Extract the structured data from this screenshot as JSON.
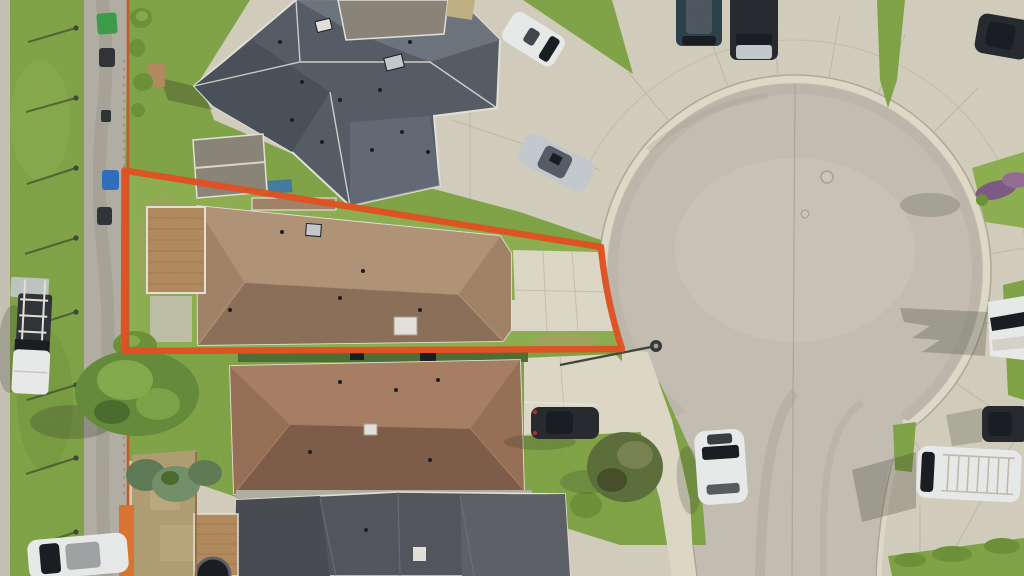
{
  "scene": {
    "type": "aerial-drone-photo",
    "subject": "residential cul-de-sac street with one property lot outlined by an orange boundary overlay"
  },
  "colors": {
    "boundary": "#E8501E",
    "concrete": "#d8d2c1",
    "concrete_light": "#e4ddcb",
    "concrete_dark": "#c6bfad",
    "bulb": "#c9c3b6",
    "bulb_light": "#d2ccbf",
    "lane": "#b6b2a7",
    "lane_stain": "#a09c90",
    "walk_left": "#cac6b9",
    "grass": "#82a746",
    "grass_bright": "#8fb350",
    "grass_dark": "#6d9436",
    "grass_dry": "#a9a565",
    "dirt": "#b3a174",
    "dirt_light": "#c4b584",
    "hedge": "#4e6e33",
    "tree": "#648e39",
    "tree_light": "#85ae4c",
    "tree_dark": "#4a6d2c",
    "spruce": "#5e7d55",
    "spruce_light": "#74926b",
    "conifer": "#5d6f3b",
    "conifer_light": "#7a8450",
    "conifer_dark": "#454e28",
    "shrub_purple": "#7e5a85",
    "shrub_purple_light": "#966f97",
    "roof_top": "#565c66",
    "roof_top_light": "#6f7681",
    "roof_top_dark": "#49505a",
    "roof_subject": "#a48468",
    "roof_subject_light": "#b59678",
    "roof_subject_dark": "#8d7059",
    "roof_lower": "#997056",
    "roof_lower_light": "#aa8064",
    "roof_lower_dark": "#7f5c48",
    "roof_bottom": "#52565c",
    "roof_bottom_dark": "#474b51",
    "roof_bottom_light": "#5d6168",
    "trim": "#eae7df",
    "shed_roof": "#8d8679",
    "deck_wood": "#b68c5e",
    "deck_line": "#9a7448",
    "fence_orange": "#c05f2b",
    "fence_orange_bright": "#e1752f",
    "vehicle_white": "#eff1f0",
    "vehicle_silver": "#c9ced3",
    "vehicle_dark": "#24272c",
    "vehicle_teal": "#27404a",
    "glass_dark": "#161b20",
    "bin_green": "#3aa04a",
    "bin_blue": "#2f6fc0",
    "bin_dark": "#2e3236",
    "pole": "#41453b",
    "shadow": "#2a3022",
    "curb_gutter": "#e6dfcd",
    "curb_line": "#aaa396",
    "seam": "#c3bcab",
    "light_head": "#34383c"
  }
}
